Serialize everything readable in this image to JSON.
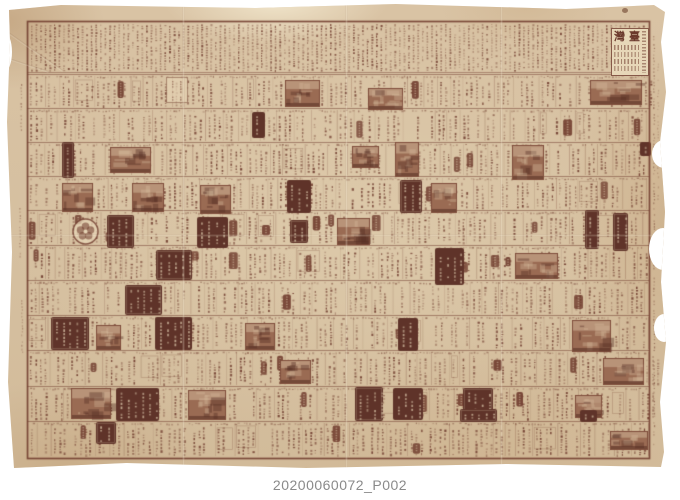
{
  "masthead": {
    "char_left": "灣",
    "char_right": "臺",
    "title": "臺灣"
  },
  "caption": {
    "text": "20200060072_P002"
  },
  "colors": {
    "backdrop": "#ffffff",
    "paper": "#d8c2a3",
    "paper_light": "#e9dcc0",
    "paper_dark": "#c2a482",
    "ink": "#6e3a2c",
    "ink_rgb": "110,58,44",
    "ink_block": "#5f3329",
    "light_rgb": "231,213,183",
    "photo": "#9a6b53",
    "photo_dark": "86,46,34",
    "photo_light": "214,188,158",
    "caption_text": "#8a8a8a"
  },
  "layout": {
    "frame": {
      "x": 27,
      "y": 21,
      "w": 622,
      "h": 437
    },
    "directory_bottom": 72,
    "row_tops": [
      74,
      108,
      142,
      176,
      210,
      245,
      280,
      315,
      350,
      386,
      421
    ],
    "creases_x": [
      182,
      345,
      500
    ]
  },
  "blocks": [
    {
      "type": "photo",
      "x": 285,
      "y": 80,
      "w": 35,
      "h": 27
    },
    {
      "type": "photo",
      "x": 368,
      "y": 88,
      "w": 35,
      "h": 22
    },
    {
      "type": "photo",
      "x": 590,
      "y": 80,
      "w": 52,
      "h": 25
    },
    {
      "type": "photo",
      "x": 110,
      "y": 147,
      "w": 41,
      "h": 26
    },
    {
      "type": "photo",
      "x": 352,
      "y": 146,
      "w": 27,
      "h": 22
    },
    {
      "type": "photo",
      "x": 395,
      "y": 142,
      "w": 24,
      "h": 35
    },
    {
      "type": "photo",
      "x": 512,
      "y": 145,
      "w": 32,
      "h": 35
    },
    {
      "type": "photo",
      "x": 62,
      "y": 183,
      "w": 31,
      "h": 29
    },
    {
      "type": "photo",
      "x": 132,
      "y": 183,
      "w": 32,
      "h": 29
    },
    {
      "type": "photo",
      "x": 200,
      "y": 185,
      "w": 31,
      "h": 29
    },
    {
      "type": "photo",
      "x": 431,
      "y": 183,
      "w": 26,
      "h": 30
    },
    {
      "type": "photo",
      "x": 337,
      "y": 218,
      "w": 33,
      "h": 27
    },
    {
      "type": "photo",
      "x": 515,
      "y": 253,
      "w": 43,
      "h": 26
    },
    {
      "type": "photo",
      "x": 96,
      "y": 325,
      "w": 25,
      "h": 25
    },
    {
      "type": "photo",
      "x": 245,
      "y": 323,
      "w": 30,
      "h": 27
    },
    {
      "type": "photo",
      "x": 572,
      "y": 320,
      "w": 39,
      "h": 32
    },
    {
      "type": "photo",
      "x": 280,
      "y": 360,
      "w": 31,
      "h": 24
    },
    {
      "type": "photo",
      "x": 603,
      "y": 358,
      "w": 41,
      "h": 27
    },
    {
      "type": "photo",
      "x": 71,
      "y": 388,
      "w": 40,
      "h": 31
    },
    {
      "type": "photo",
      "x": 188,
      "y": 390,
      "w": 38,
      "h": 30
    },
    {
      "type": "photo",
      "x": 610,
      "y": 431,
      "w": 38,
      "h": 19
    },
    {
      "type": "photo",
      "x": 575,
      "y": 395,
      "w": 27,
      "h": 23
    },
    {
      "type": "dark",
      "x": 252,
      "y": 112,
      "w": 13,
      "h": 26
    },
    {
      "type": "dark",
      "x": 62,
      "y": 142,
      "w": 12,
      "h": 36
    },
    {
      "type": "dark",
      "x": 640,
      "y": 142,
      "w": 11,
      "h": 14
    },
    {
      "type": "dark",
      "x": 287,
      "y": 180,
      "w": 24,
      "h": 33
    },
    {
      "type": "dark",
      "x": 400,
      "y": 180,
      "w": 22,
      "h": 33
    },
    {
      "type": "dark",
      "x": 107,
      "y": 215,
      "w": 27,
      "h": 33
    },
    {
      "type": "dark",
      "x": 197,
      "y": 217,
      "w": 31,
      "h": 31
    },
    {
      "type": "dark",
      "x": 290,
      "y": 220,
      "w": 18,
      "h": 23
    },
    {
      "type": "dark",
      "x": 585,
      "y": 210,
      "w": 14,
      "h": 39
    },
    {
      "type": "dark",
      "x": 613,
      "y": 213,
      "w": 15,
      "h": 38
    },
    {
      "type": "dark",
      "x": 435,
      "y": 248,
      "w": 29,
      "h": 37
    },
    {
      "type": "dark",
      "x": 156,
      "y": 250,
      "w": 36,
      "h": 30
    },
    {
      "type": "dark",
      "x": 125,
      "y": 285,
      "w": 37,
      "h": 30
    },
    {
      "type": "dark",
      "x": 51,
      "y": 317,
      "w": 38,
      "h": 33
    },
    {
      "type": "dark",
      "x": 155,
      "y": 317,
      "w": 37,
      "h": 33
    },
    {
      "type": "dark",
      "x": 398,
      "y": 318,
      "w": 20,
      "h": 33
    },
    {
      "type": "dark",
      "x": 116,
      "y": 388,
      "w": 43,
      "h": 33
    },
    {
      "type": "dark",
      "x": 355,
      "y": 387,
      "w": 28,
      "h": 34
    },
    {
      "type": "dark",
      "x": 393,
      "y": 388,
      "w": 30,
      "h": 32
    },
    {
      "type": "dark",
      "x": 463,
      "y": 388,
      "w": 30,
      "h": 32
    },
    {
      "type": "dark",
      "x": 460,
      "y": 409,
      "w": 37,
      "h": 13
    },
    {
      "type": "dark",
      "x": 580,
      "y": 410,
      "w": 17,
      "h": 12
    },
    {
      "type": "dark",
      "x": 96,
      "y": 422,
      "w": 20,
      "h": 22
    },
    {
      "type": "logo",
      "x": 72,
      "y": 218,
      "w": 27,
      "h": 27
    },
    {
      "type": "box",
      "x": 166,
      "y": 77,
      "w": 22,
      "h": 26
    }
  ]
}
